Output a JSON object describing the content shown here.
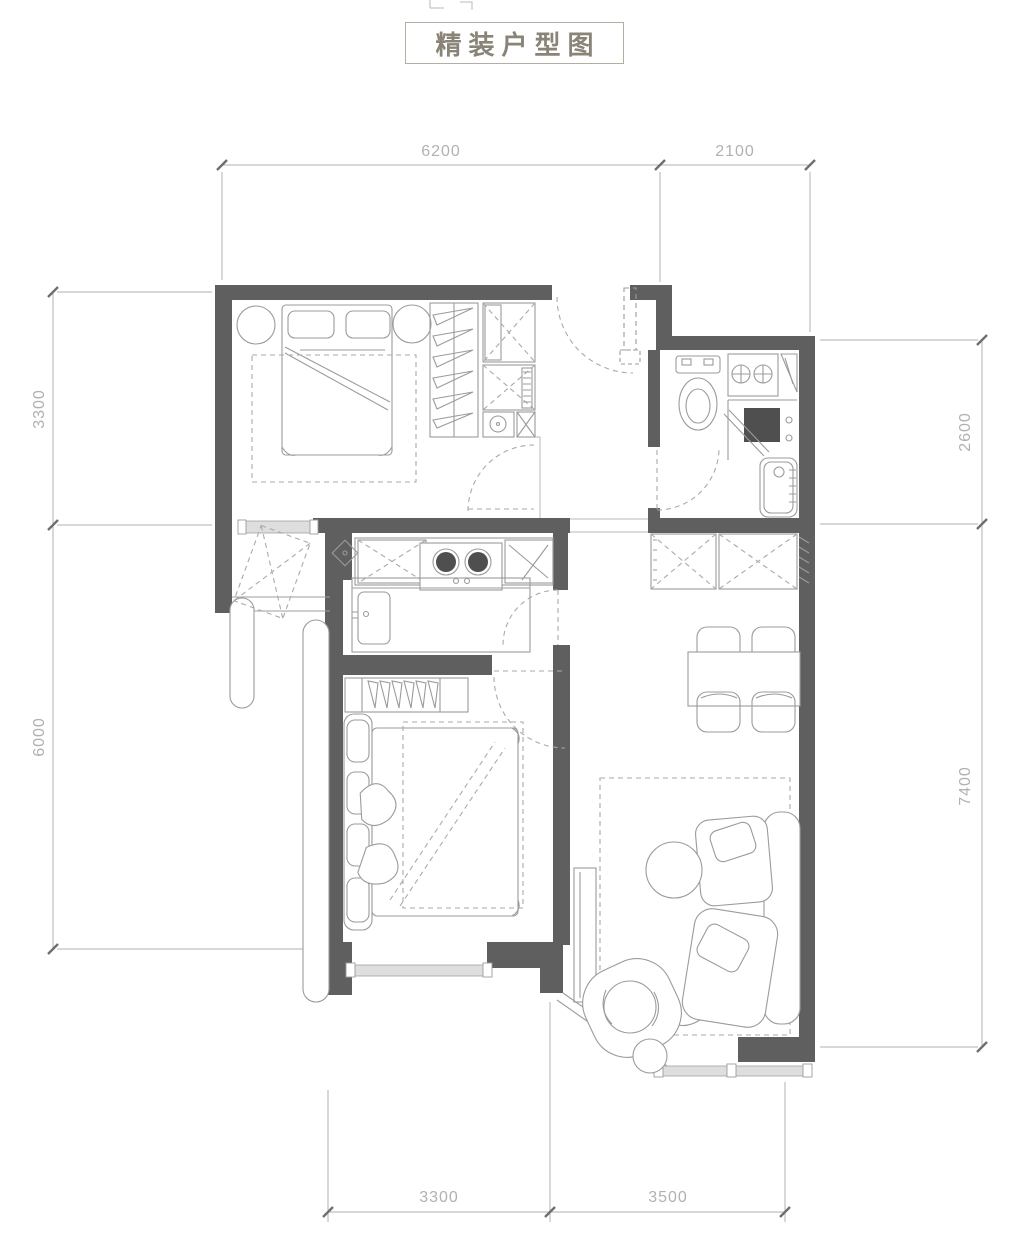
{
  "title": {
    "text": "精装户型图"
  },
  "dimensions": {
    "top": {
      "segments": [
        {
          "label": "6200"
        },
        {
          "label": "2100"
        }
      ]
    },
    "left": {
      "segments": [
        {
          "label": "3300"
        },
        {
          "label": "6000"
        }
      ]
    },
    "right": {
      "segments": [
        {
          "label": "2600"
        },
        {
          "label": "7400"
        }
      ]
    },
    "bottom": {
      "segments": [
        {
          "label": "3300"
        },
        {
          "label": "3500"
        }
      ]
    }
  },
  "colors": {
    "wall": "#5f5f5f",
    "furniture_line": "#9b9b9b",
    "dimension_text": "#b3b1ae",
    "title_text": "#8a8478",
    "title_border": "#b3ada2",
    "window_fill": "#dedede"
  },
  "icons": {
    "double_bed": "double-bed-icon",
    "wardrobe": "wardrobe-hangers-icon",
    "toilet": "toilet-icon",
    "bathtub": "bathtub-icon",
    "shower": "shower-icon",
    "stove": "gas-stove-icon",
    "sink": "kitchen-sink-icon",
    "dining_set": "dining-table-icon",
    "sofa": "sofa-icon",
    "coffee_table": "coffee-table-icon",
    "armchair": "armchair-icon"
  }
}
